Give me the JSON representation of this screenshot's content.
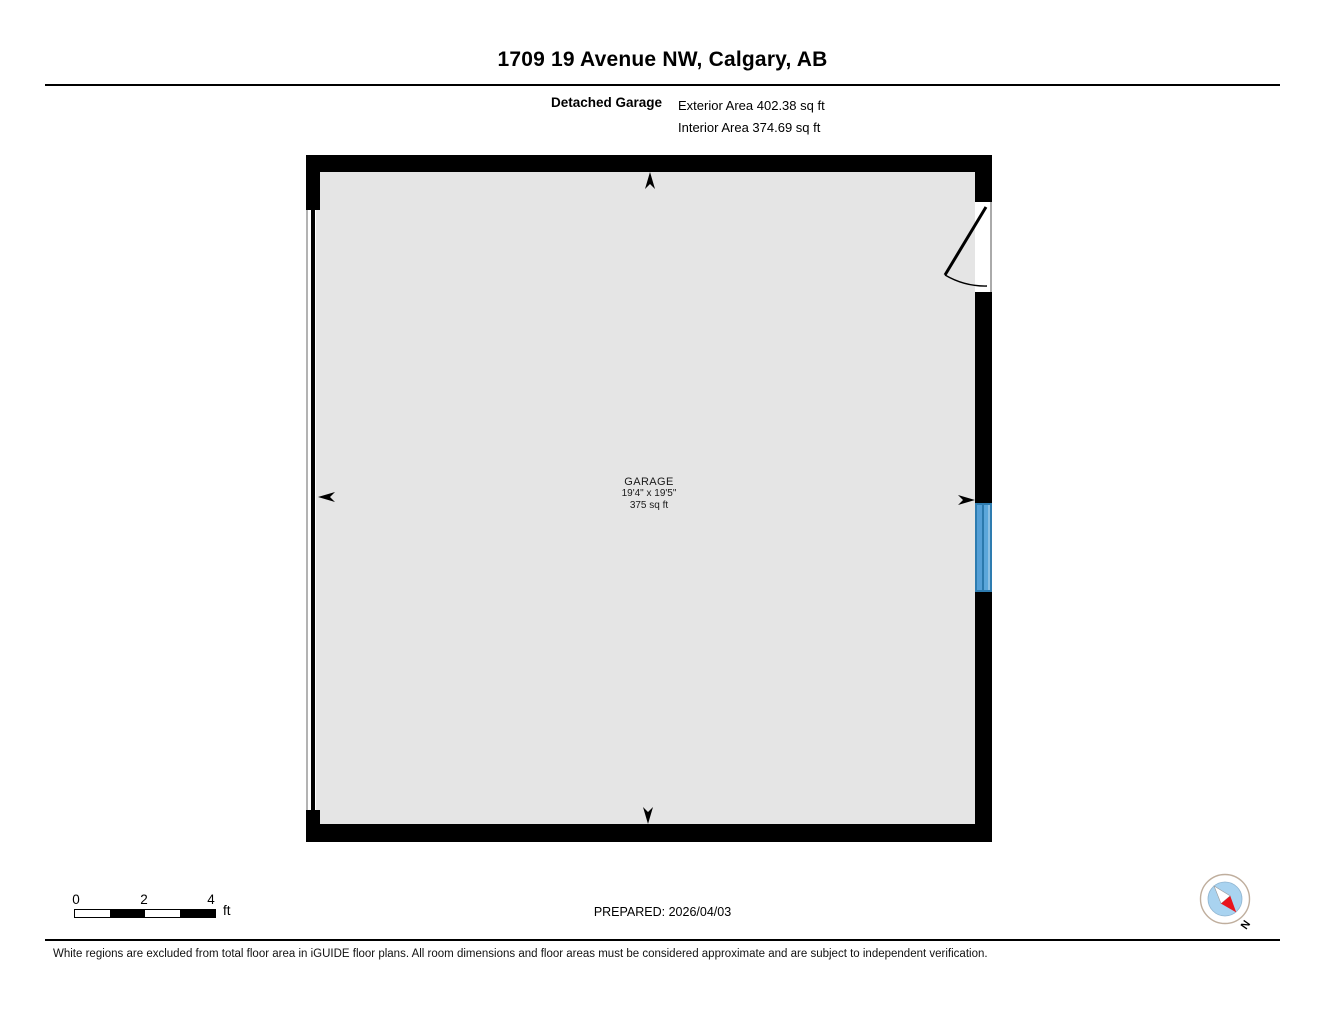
{
  "header": {
    "title": "1709 19 Avenue NW, Calgary, AB",
    "plan_label": "Detached Garage",
    "exterior_area": "Exterior Area 402.38 sq ft",
    "interior_area": "Interior Area 374.69 sq ft"
  },
  "plan": {
    "room": {
      "name": "GARAGE",
      "dimensions": "19'4\" x 19'5\"",
      "area": "375 sq ft"
    },
    "features": {
      "left_wall": "garage-door-opening",
      "right_wall_top": "swing-door-into-room",
      "right_wall_middle": "window"
    }
  },
  "scale_bar": {
    "ticks": [
      "0",
      "2",
      "4"
    ],
    "unit": "ft"
  },
  "footer": {
    "prepared": "PREPARED: 2026/04/03",
    "disclaimer": "White regions are excluded from total floor area in iGUIDE floor plans. All room dimensions and floor areas must be considered approximate and are subject to independent verification."
  },
  "compass": {
    "north_label": "N"
  },
  "icons": {
    "compass": "compass-rose-icon",
    "arrows": [
      "measure-arrow-up",
      "measure-arrow-down",
      "measure-arrow-left",
      "measure-arrow-right"
    ]
  },
  "colors": {
    "wall": "#000000",
    "floor": "#e5e5e5",
    "window_blue": "#55a1d7",
    "window_blue_dark": "#2e7cb0",
    "compass_inner_blue": "#a9d3f0",
    "needle_red": "#e8141c"
  }
}
